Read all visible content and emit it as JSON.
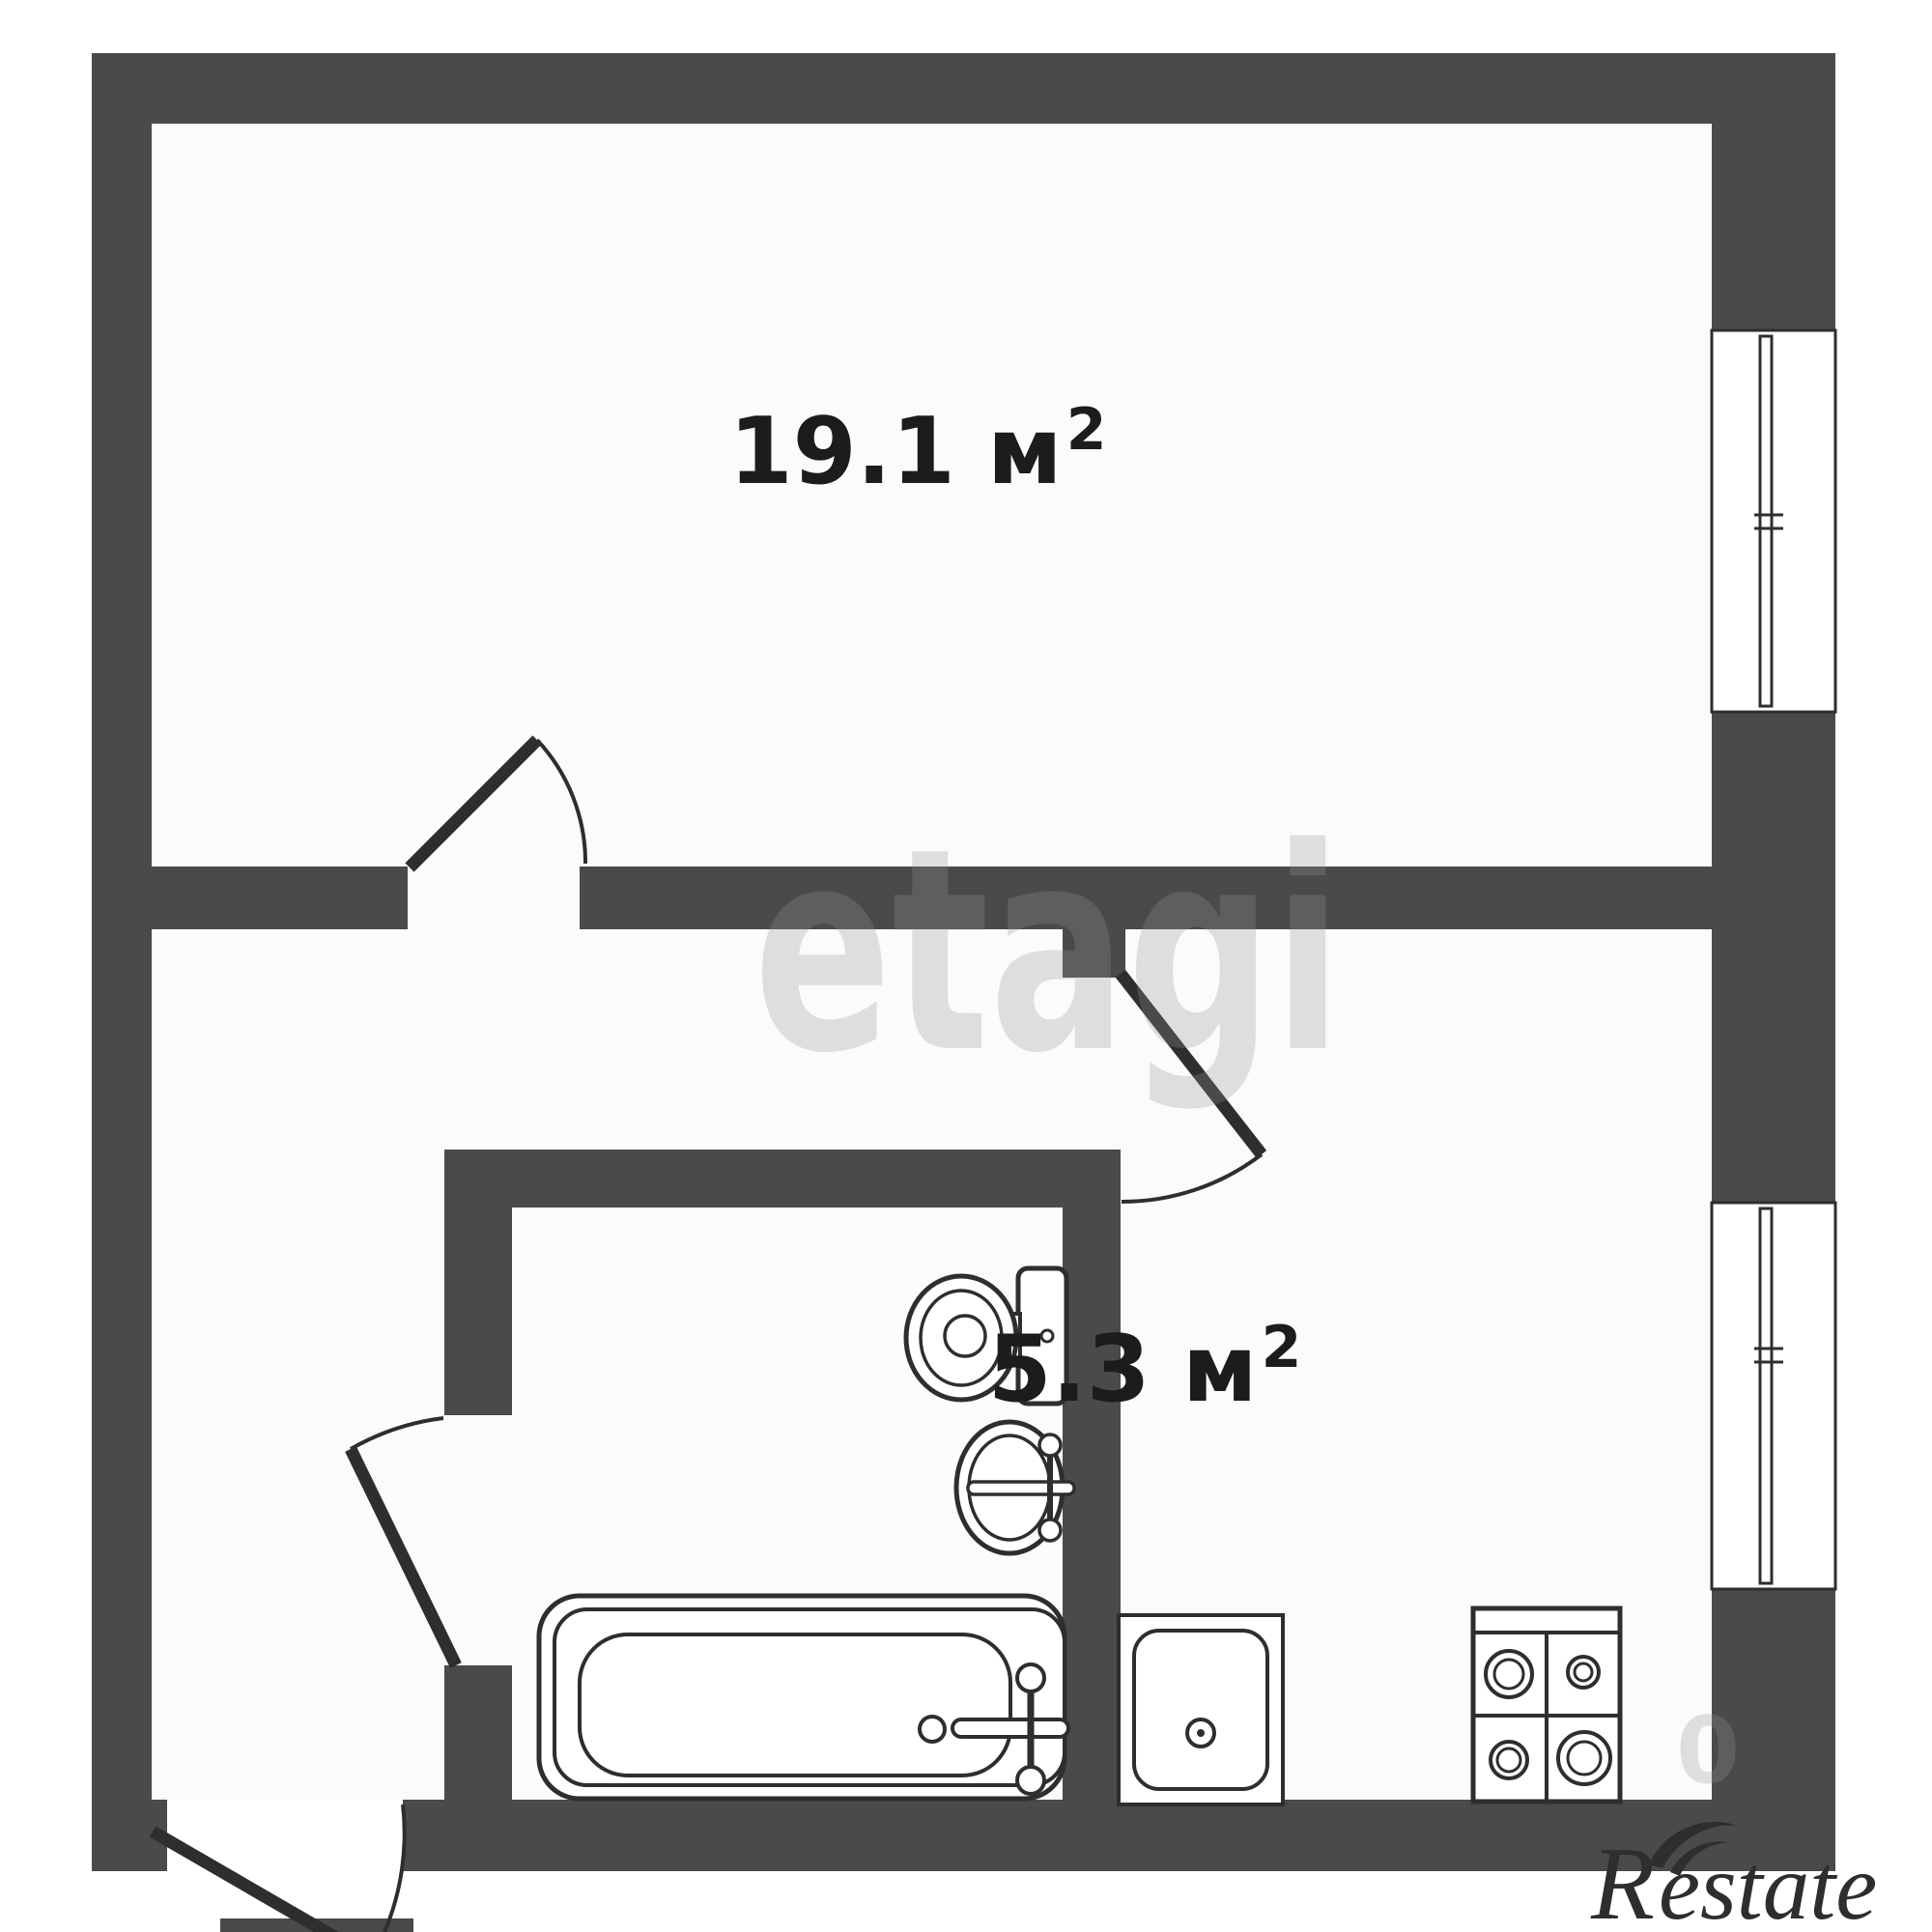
{
  "page": {
    "background": "#ffffff",
    "room_fill": "#fbfbfc"
  },
  "colors": {
    "wall": "#4a4a4b",
    "line": "#2e2e30",
    "label": "#1c1c1e",
    "watermark": "rgba(148,148,155,0.28)",
    "brand": "#2e2e30",
    "white": "#ffffff"
  },
  "rooms": [
    {
      "id": "living-room",
      "area_label": "19.1 м²",
      "area_main": "19.1 м",
      "area_sup": "2"
    },
    {
      "id": "kitchen",
      "area_label": "5.3 м²",
      "area_main": "5.3 м",
      "area_sup": "2"
    }
  ],
  "watermarks": {
    "center": "etagi",
    "digit": "0"
  },
  "brand": {
    "initial": "R",
    "rest": "estate"
  },
  "fixtures": [
    {
      "name": "bathtub"
    },
    {
      "name": "toilet"
    },
    {
      "name": "wash-basin"
    },
    {
      "name": "kitchen-sink"
    },
    {
      "name": "stove"
    },
    {
      "name": "window-living-room"
    },
    {
      "name": "window-kitchen"
    },
    {
      "name": "door-living-room"
    },
    {
      "name": "door-kitchen"
    },
    {
      "name": "door-bathroom"
    },
    {
      "name": "door-entrance"
    }
  ]
}
